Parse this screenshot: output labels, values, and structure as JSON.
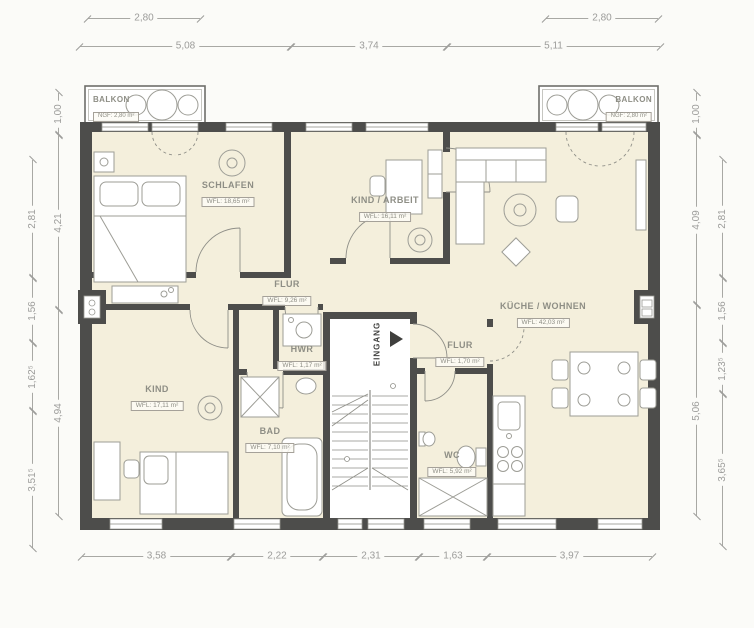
{
  "colors": {
    "background": "#fbfbf8",
    "wall": "#4d4d4b",
    "floor": "#f4efdc",
    "furniture_outline": "#9d9d96",
    "dimension": "#9c9c9a",
    "label": "#8e8e85"
  },
  "rooms": [
    {
      "name": "SCHLAFEN",
      "area": "WFL: 18,65 m²"
    },
    {
      "name": "KIND / ARBEIT",
      "area": "WFL: 16,11 m²"
    },
    {
      "name": "KÜCHE / WOHNEN",
      "area": "WFL: 42,03 m²"
    },
    {
      "name": "FLUR",
      "area": "WFL: 9,26 m²"
    },
    {
      "name": "HWR",
      "area": "WFL: 1,17 m²"
    },
    {
      "name": "FLUR",
      "area": "WFL: 1,70 m²"
    },
    {
      "name": "KIND",
      "area": "WFL: 17,11 m²"
    },
    {
      "name": "BAD",
      "area": "WFL: 7,10 m²"
    },
    {
      "name": "WC",
      "area": "WFL: 5,92 m²"
    }
  ],
  "balconies": [
    {
      "name": "BALKON",
      "area": "NGF: 2,80 m²"
    },
    {
      "name": "BALKON",
      "area": "NGF: 2,80 m²"
    }
  ],
  "entrance": {
    "label": "EINGANG"
  },
  "dimensions": {
    "top_row1": [
      {
        "label": "2,80"
      },
      {
        "label": "2,80"
      }
    ],
    "top_row2": [
      {
        "label": "5,08"
      },
      {
        "label": "3,74"
      },
      {
        "label": "5,11"
      }
    ],
    "bottom": [
      {
        "label": "3,58"
      },
      {
        "label": "2,22"
      },
      {
        "label": "2,31"
      },
      {
        "label": "1,63"
      },
      {
        "label": "3,97"
      }
    ],
    "left_inner": [
      {
        "label": "1,00"
      },
      {
        "label": "4,21"
      },
      {
        "label": "4,94"
      }
    ],
    "left_outer": [
      {
        "label": "2,81"
      },
      {
        "label": "1,56"
      },
      {
        "label": "1,62⁵"
      },
      {
        "label": "3,51⁵"
      }
    ],
    "right_inner": [
      {
        "label": "1,00"
      },
      {
        "label": "4,09"
      },
      {
        "label": "5,06"
      }
    ],
    "right_outer": [
      {
        "label": "2,81"
      },
      {
        "label": "1,56"
      },
      {
        "label": "1,23⁵"
      },
      {
        "label": "3,65⁵"
      }
    ]
  }
}
